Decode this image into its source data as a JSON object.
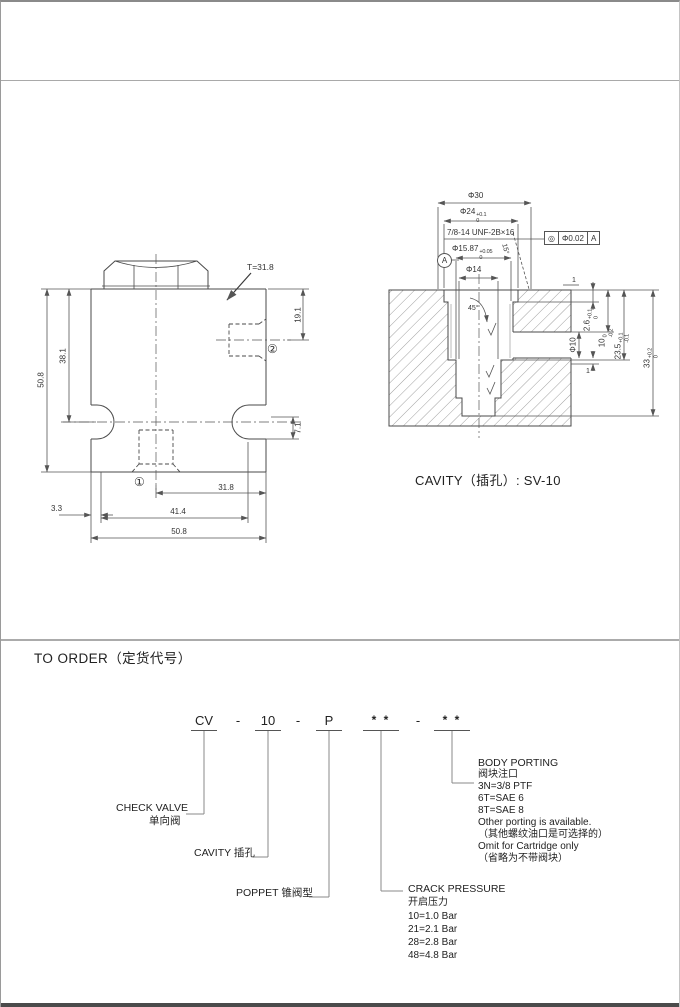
{
  "drawing": {
    "t_label": "T=31.8",
    "dims": {
      "h19_1": "19.1",
      "h38_1": "38.1",
      "h50_8": "50.8",
      "h7_1": "7.1",
      "w31_8": "31.8",
      "w3_3": "3.3",
      "w41_4": "41.4",
      "w50_8": "50.8"
    },
    "ports": {
      "p1": "①",
      "p2": "②"
    }
  },
  "cavity": {
    "caption": "CAVITY（插孔）: SV-10",
    "dims": {
      "phi30": "Φ30",
      "phi24": {
        "main": "Φ24",
        "sup": "+0.1",
        "sub": "0"
      },
      "thread": "7/8-14 UNF-2B×16",
      "phi15_87": {
        "main": "Φ15.87",
        "sup": "+0.05",
        "sub": "0"
      },
      "phi14": "Φ14",
      "angle45": "45°",
      "angle15": "15°",
      "d1_top": "1",
      "d1_bottom": "1",
      "d2_6": {
        "main": "2.6",
        "sup": "+0.1",
        "sub": "0"
      },
      "d10": {
        "main": "10",
        "sup": "0",
        "sub": "-0.2"
      },
      "d23_5": {
        "main": "23.5",
        "sup": "+0.1",
        "sub": "-0.1"
      },
      "d33": {
        "main": "33",
        "sup": "+0.2",
        "sub": "0"
      },
      "phi10": "Φ10"
    },
    "gdt": {
      "symbol": "◎",
      "tolerance": "Φ0.02",
      "datum": "A"
    },
    "datum_label": "A"
  },
  "order": {
    "title": "TO ORDER（定货代号）",
    "code": {
      "prefix": "CV",
      "separator": "-",
      "size": "10",
      "poppet": "P",
      "stars": "* *"
    },
    "check_valve": {
      "en": "CHECK VALVE",
      "cn": "单向阀"
    },
    "cavity_label": "CAVITY  插孔",
    "poppet_label": "POPPET  锥阀型",
    "crack_pressure": {
      "title": "CRACK PRESSURE",
      "cn": "开启压力",
      "options": [
        "10=1.0 Bar",
        "21=2.1 Bar",
        "28=2.8 Bar",
        "48=4.8 Bar"
      ]
    },
    "body_porting": {
      "title": "BODY PORTING",
      "cn": "阀块注口",
      "lines": [
        "3N=3/8  PTF",
        "6T=SAE  6",
        "8T=SAE  8",
        "Other porting is available.",
        "（其他螺纹油口是可选择的）",
        "Omit for Cartridge only",
        "（省略为不带阀块）"
      ]
    }
  }
}
